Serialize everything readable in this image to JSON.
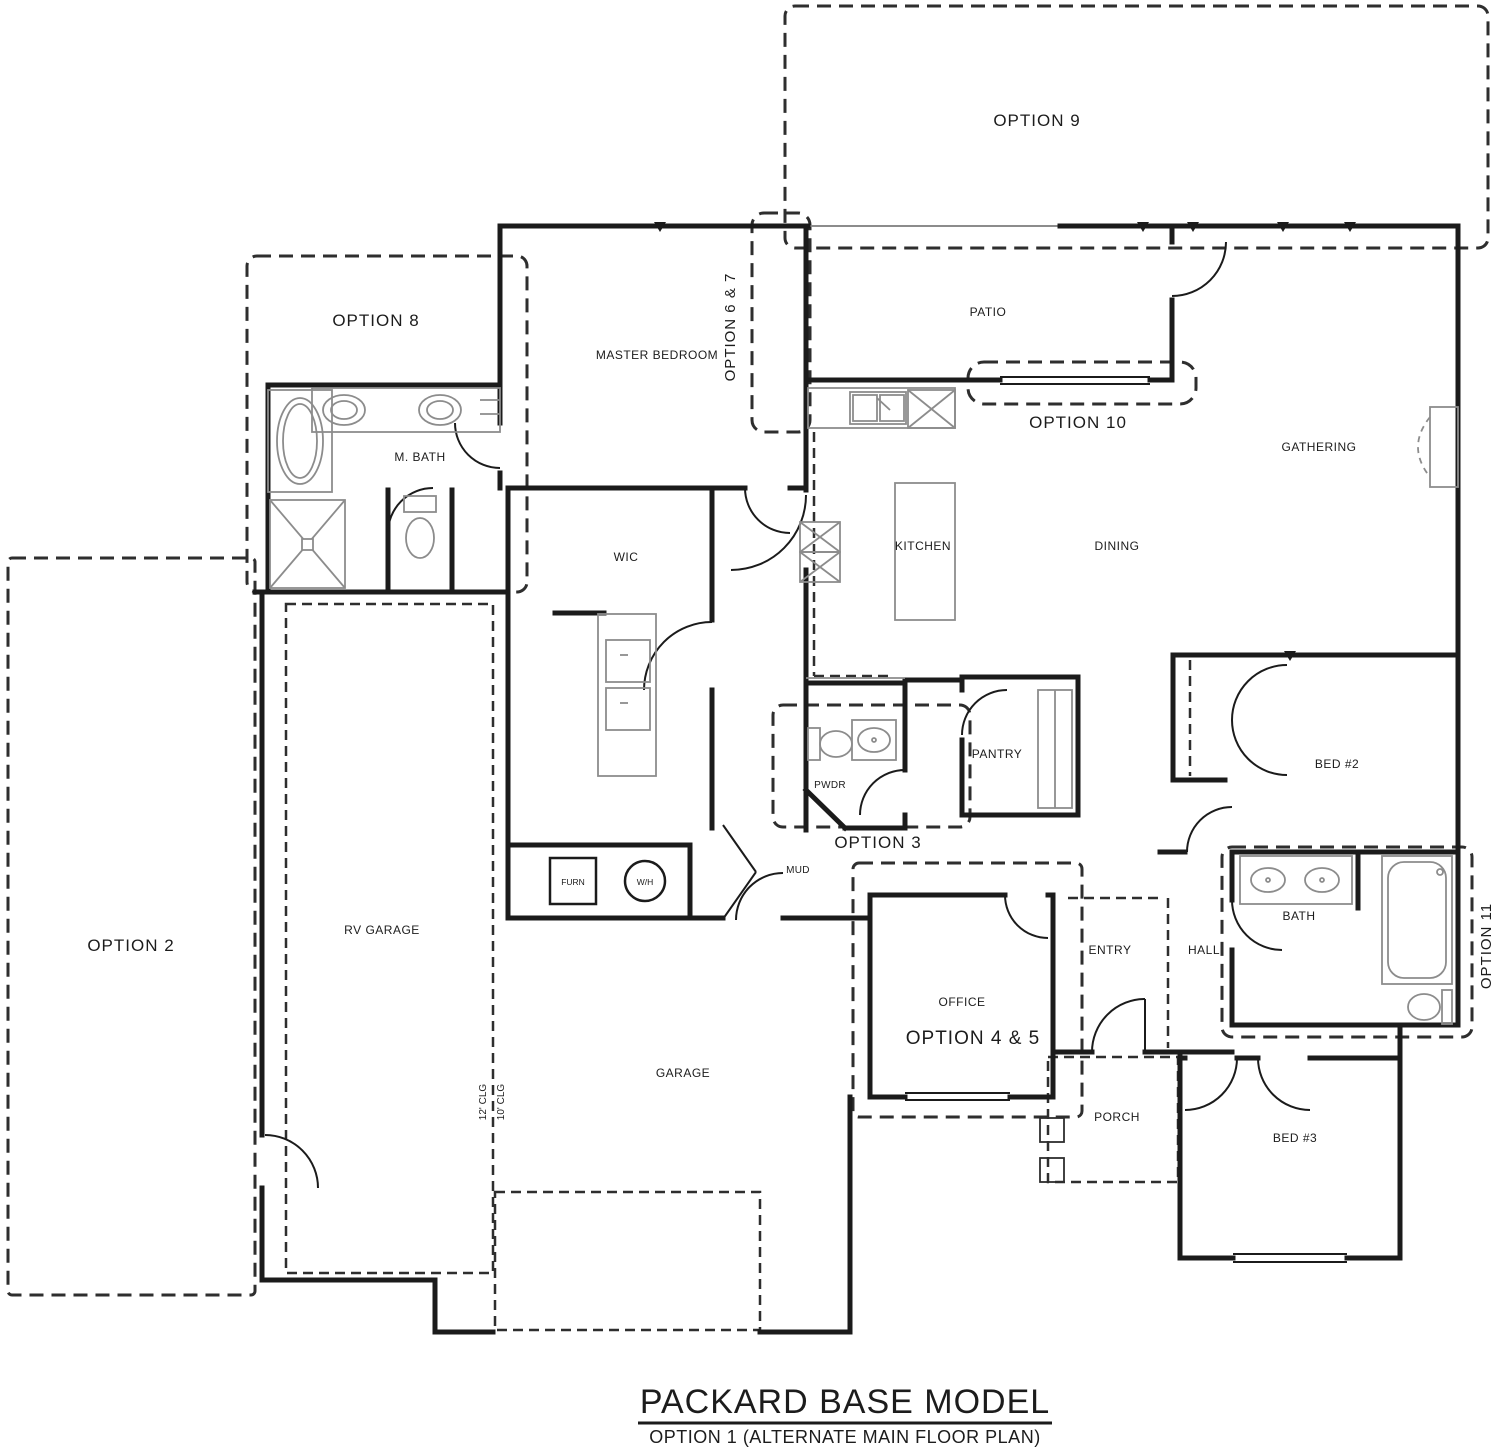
{
  "titleblock": {
    "title": "PACKARD BASE MODEL",
    "subtitle": "OPTION 1 (ALTERNATE MAIN FLOOR PLAN)"
  },
  "rooms": {
    "master_bedroom": "MASTER BEDROOM",
    "m_bath": "M. BATH",
    "wic": "WIC",
    "patio": "PATIO",
    "kitchen": "KITCHEN",
    "dining": "DINING",
    "gathering": "GATHERING",
    "pwdr": "PWDR",
    "pantry": "PANTRY",
    "mud": "MUD",
    "furn": "FURN",
    "wh": "W/H",
    "rv_garage": "RV GARAGE",
    "garage": "GARAGE",
    "office": "OFFICE",
    "entry": "ENTRY",
    "hall": "HALL",
    "bath": "BATH",
    "bed2": "BED #2",
    "bed3": "BED #3",
    "porch": "PORCH"
  },
  "options": {
    "o2": "OPTION 2",
    "o3": "OPTION 3",
    "o45": "OPTION 4 & 5",
    "o67": "OPTION 6 & 7",
    "o8": "OPTION 8",
    "o9": "OPTION 9",
    "o10": "OPTION 10",
    "o11": "OPTION 11"
  },
  "notes": {
    "clg12": "12' CLG",
    "clg10": "10' CLG"
  },
  "colors": {
    "wall": "#1b1b1b",
    "fixture": "#8c8c8c",
    "dash": "#2e2e2e"
  }
}
